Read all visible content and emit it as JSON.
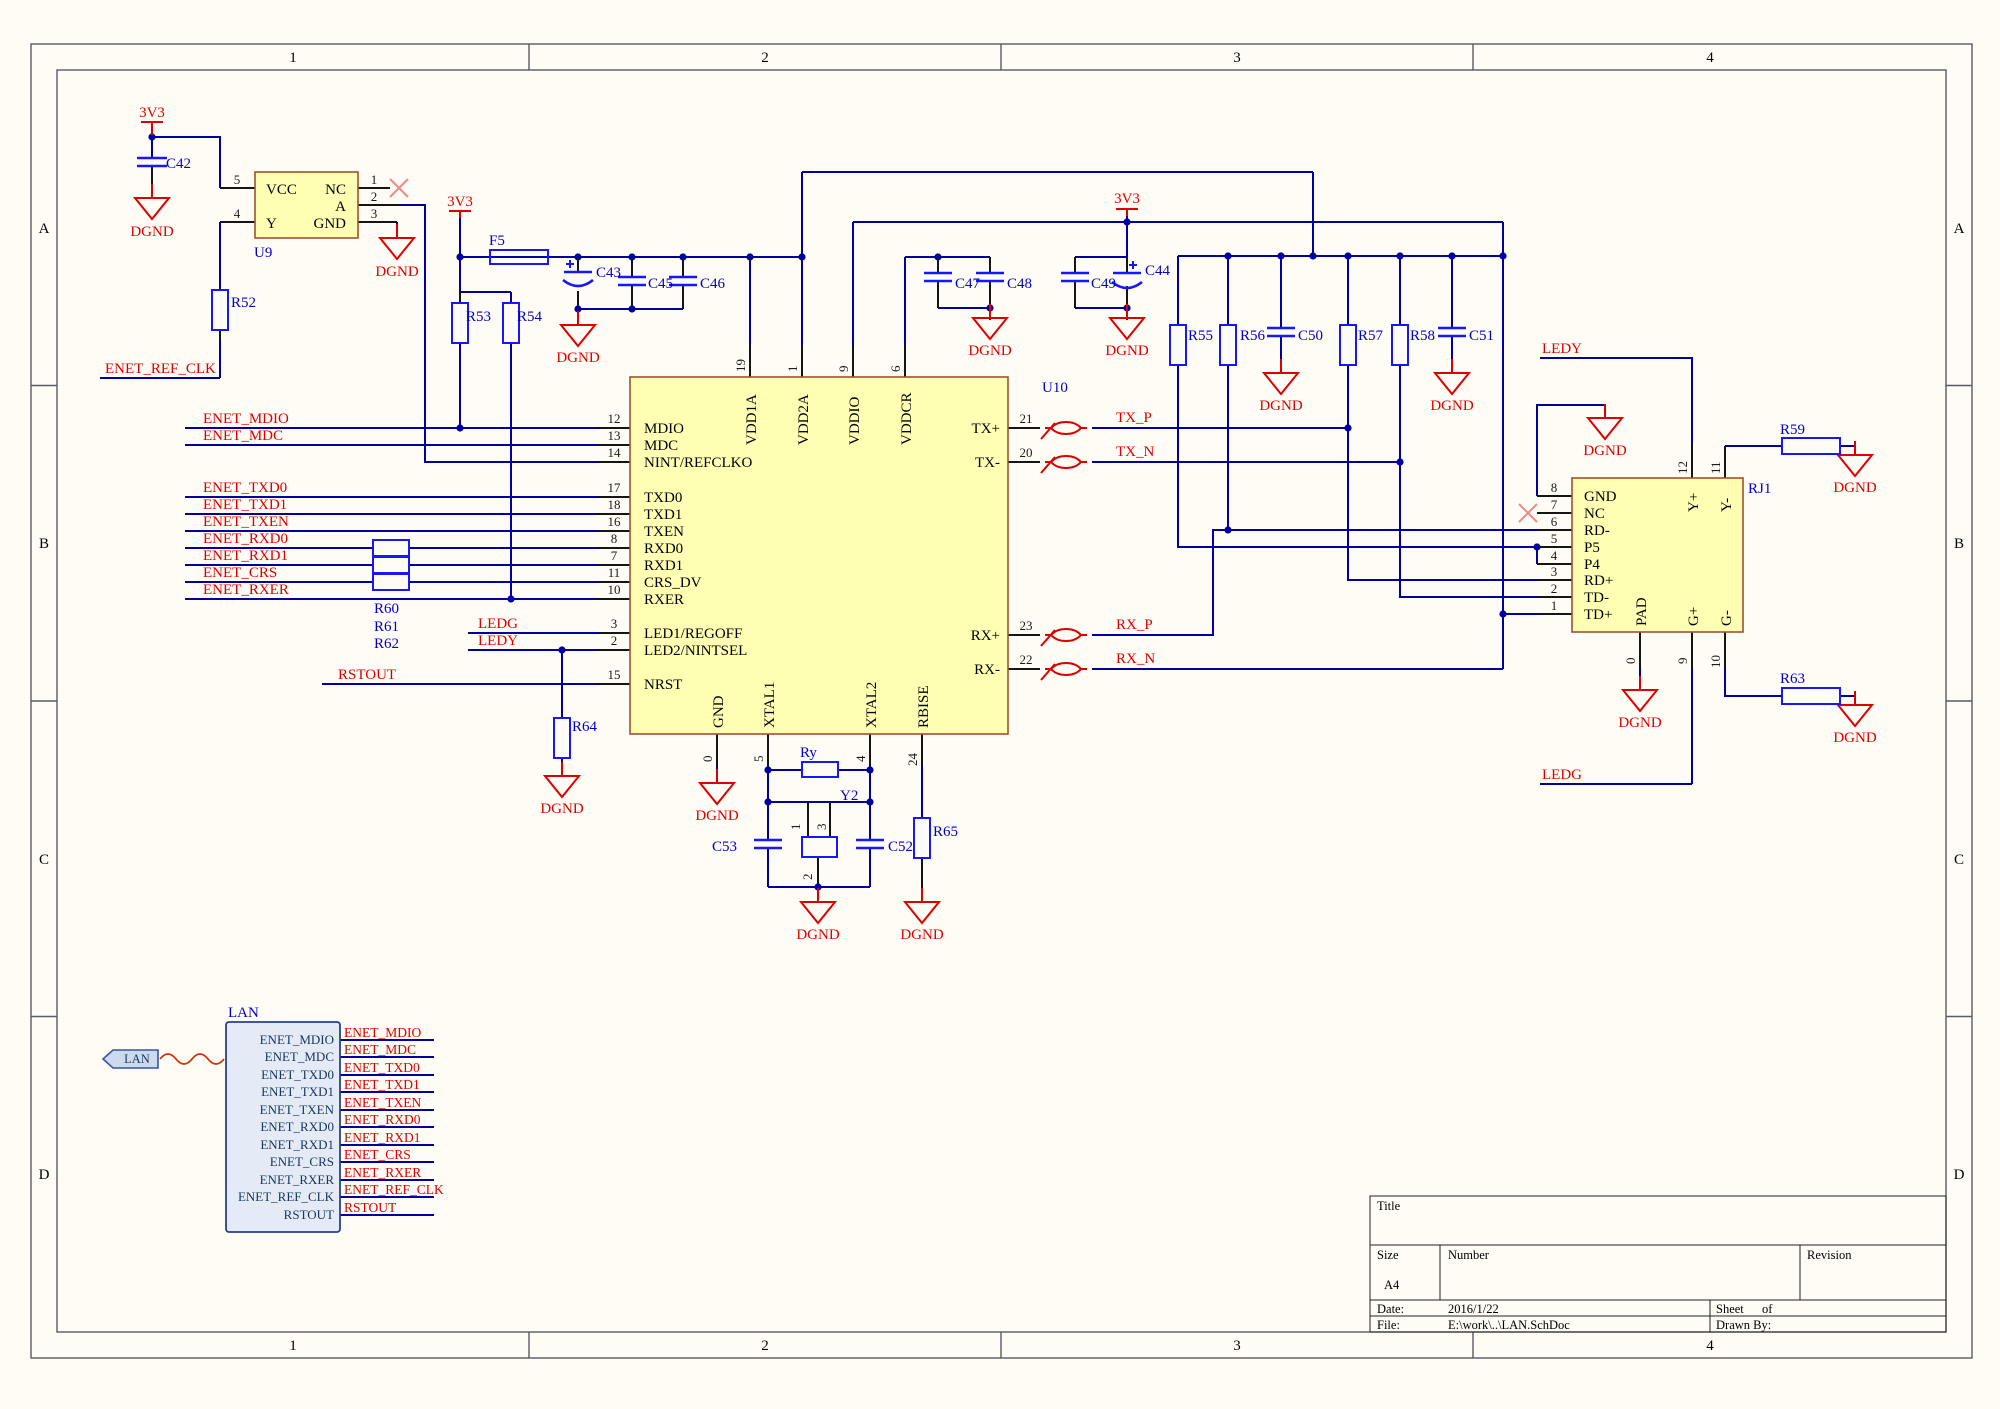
{
  "sheet": {
    "zones_h": [
      "1",
      "2",
      "3",
      "4"
    ],
    "zones_v": [
      "A",
      "B",
      "C",
      "D"
    ]
  },
  "title_block": {
    "title_label": "Title",
    "size_label": "Size",
    "size_value": "A4",
    "number_label": "Number",
    "revision_label": "Revision",
    "date_label": "Date:",
    "date_value": "2016/1/22",
    "file_label": "File:",
    "file_value": "E:\\work\\..\\LAN.SchDoc",
    "sheet_label": "Sheet",
    "of_label": "of",
    "drawn_label": "Drawn By:"
  },
  "power": {
    "v33": "3V3",
    "dgnd": "DGND"
  },
  "nets": {
    "mdio": "ENET_MDIO",
    "mdc": "ENET_MDC",
    "txd0": "ENET_TXD0",
    "txd1": "ENET_TXD1",
    "txen": "ENET_TXEN",
    "rxd0": "ENET_RXD0",
    "rxd1": "ENET_RXD1",
    "crs": "ENET_CRS",
    "rxer": "ENET_RXER",
    "refclk": "ENET_REF_CLK",
    "rstout": "RSTOUT",
    "ledg": "LEDG",
    "ledy": "LEDY",
    "txp": "TX_P",
    "txn": "TX_N",
    "rxp": "RX_P",
    "rxn": "RX_N"
  },
  "u9": {
    "ref": "U9",
    "pin_vcc": "VCC",
    "pin_nc": "NC",
    "pin_a": "A",
    "pin_y": "Y",
    "pin_gnd": "GND",
    "n1": "1",
    "n2": "2",
    "n3": "3",
    "n4": "4",
    "n5": "5"
  },
  "u10": {
    "ref": "U10",
    "left": [
      {
        "n": "12",
        "name": "MDIO"
      },
      {
        "n": "13",
        "name": "MDC"
      },
      {
        "n": "14",
        "name": "NINT/REFCLKO"
      },
      {
        "n": "17",
        "name": "TXD0"
      },
      {
        "n": "18",
        "name": "TXD1"
      },
      {
        "n": "16",
        "name": "TXEN"
      },
      {
        "n": "8",
        "name": "RXD0"
      },
      {
        "n": "7",
        "name": "RXD1"
      },
      {
        "n": "11",
        "name": "CRS_DV"
      },
      {
        "n": "10",
        "name": "RXER"
      },
      {
        "n": "3",
        "name": "LED1/REGOFF"
      },
      {
        "n": "2",
        "name": "LED2/NINTSEL"
      },
      {
        "n": "15",
        "name": "NRST"
      }
    ],
    "top": [
      {
        "n": "19",
        "name": "VDD1A"
      },
      {
        "n": "1",
        "name": "VDD2A"
      },
      {
        "n": "9",
        "name": "VDDIO"
      },
      {
        "n": "6",
        "name": "VDDCR"
      }
    ],
    "bottom": [
      {
        "n": "0",
        "name": "GND"
      },
      {
        "n": "5",
        "name": "XTAL1"
      },
      {
        "n": "4",
        "name": "XTAL2"
      },
      {
        "n": "24",
        "name": "RBISE"
      }
    ],
    "right": [
      {
        "n": "21",
        "name": "TX+"
      },
      {
        "n": "20",
        "name": "TX-"
      },
      {
        "n": "23",
        "name": "RX+"
      },
      {
        "n": "22",
        "name": "RX-"
      }
    ]
  },
  "rj1": {
    "ref": "RJ1",
    "left": [
      {
        "n": "8",
        "name": "GND"
      },
      {
        "n": "7",
        "name": "NC"
      },
      {
        "n": "6",
        "name": "RD-"
      },
      {
        "n": "5",
        "name": "P5"
      },
      {
        "n": "4",
        "name": "P4"
      },
      {
        "n": "3",
        "name": "RD+"
      },
      {
        "n": "2",
        "name": "TD-"
      },
      {
        "n": "1",
        "name": "TD+"
      }
    ],
    "top": [
      {
        "n": "12",
        "name": "Y+"
      },
      {
        "n": "11",
        "name": "Y-"
      }
    ],
    "bottom": [
      {
        "n": "0",
        "name": "PAD"
      },
      {
        "n": "9",
        "name": "G+"
      },
      {
        "n": "10",
        "name": "G-"
      }
    ]
  },
  "refdes": {
    "f5": "F5",
    "y2": "Y2",
    "ry": "Ry",
    "r52": "R52",
    "r53": "R53",
    "r54": "R54",
    "r55": "R55",
    "r56": "R56",
    "r57": "R57",
    "r58": "R58",
    "r59": "R59",
    "r60": "R60",
    "r61": "R61",
    "r62": "R62",
    "r63": "R63",
    "r64": "R64",
    "r65": "R65",
    "c42": "C42",
    "c43": "C43",
    "c44": "C44",
    "c45": "C45",
    "c46": "C46",
    "c47": "C47",
    "c48": "C48",
    "c49": "C49",
    "c50": "C50",
    "c51": "C51",
    "c52": "C52",
    "c53": "C53"
  },
  "harness": {
    "title": "LAN",
    "port": "LAN",
    "entries": [
      "ENET_MDIO",
      "ENET_MDC",
      "ENET_TXD0",
      "ENET_TXD1",
      "ENET_TXEN",
      "ENET_RXD0",
      "ENET_RXD1",
      "ENET_CRS",
      "ENET_RXER",
      "ENET_REF_CLK",
      "RSTOUT"
    ],
    "labels": [
      "ENET_MDIO",
      "ENET_MDC",
      "ENET_TXD0",
      "ENET_TXD1",
      "ENET_TXEN",
      "ENET_RXD0",
      "ENET_RXD1",
      "ENET_CRS",
      "ENET_RXER",
      "ENET_REF_CLK",
      "RSTOUT"
    ]
  }
}
